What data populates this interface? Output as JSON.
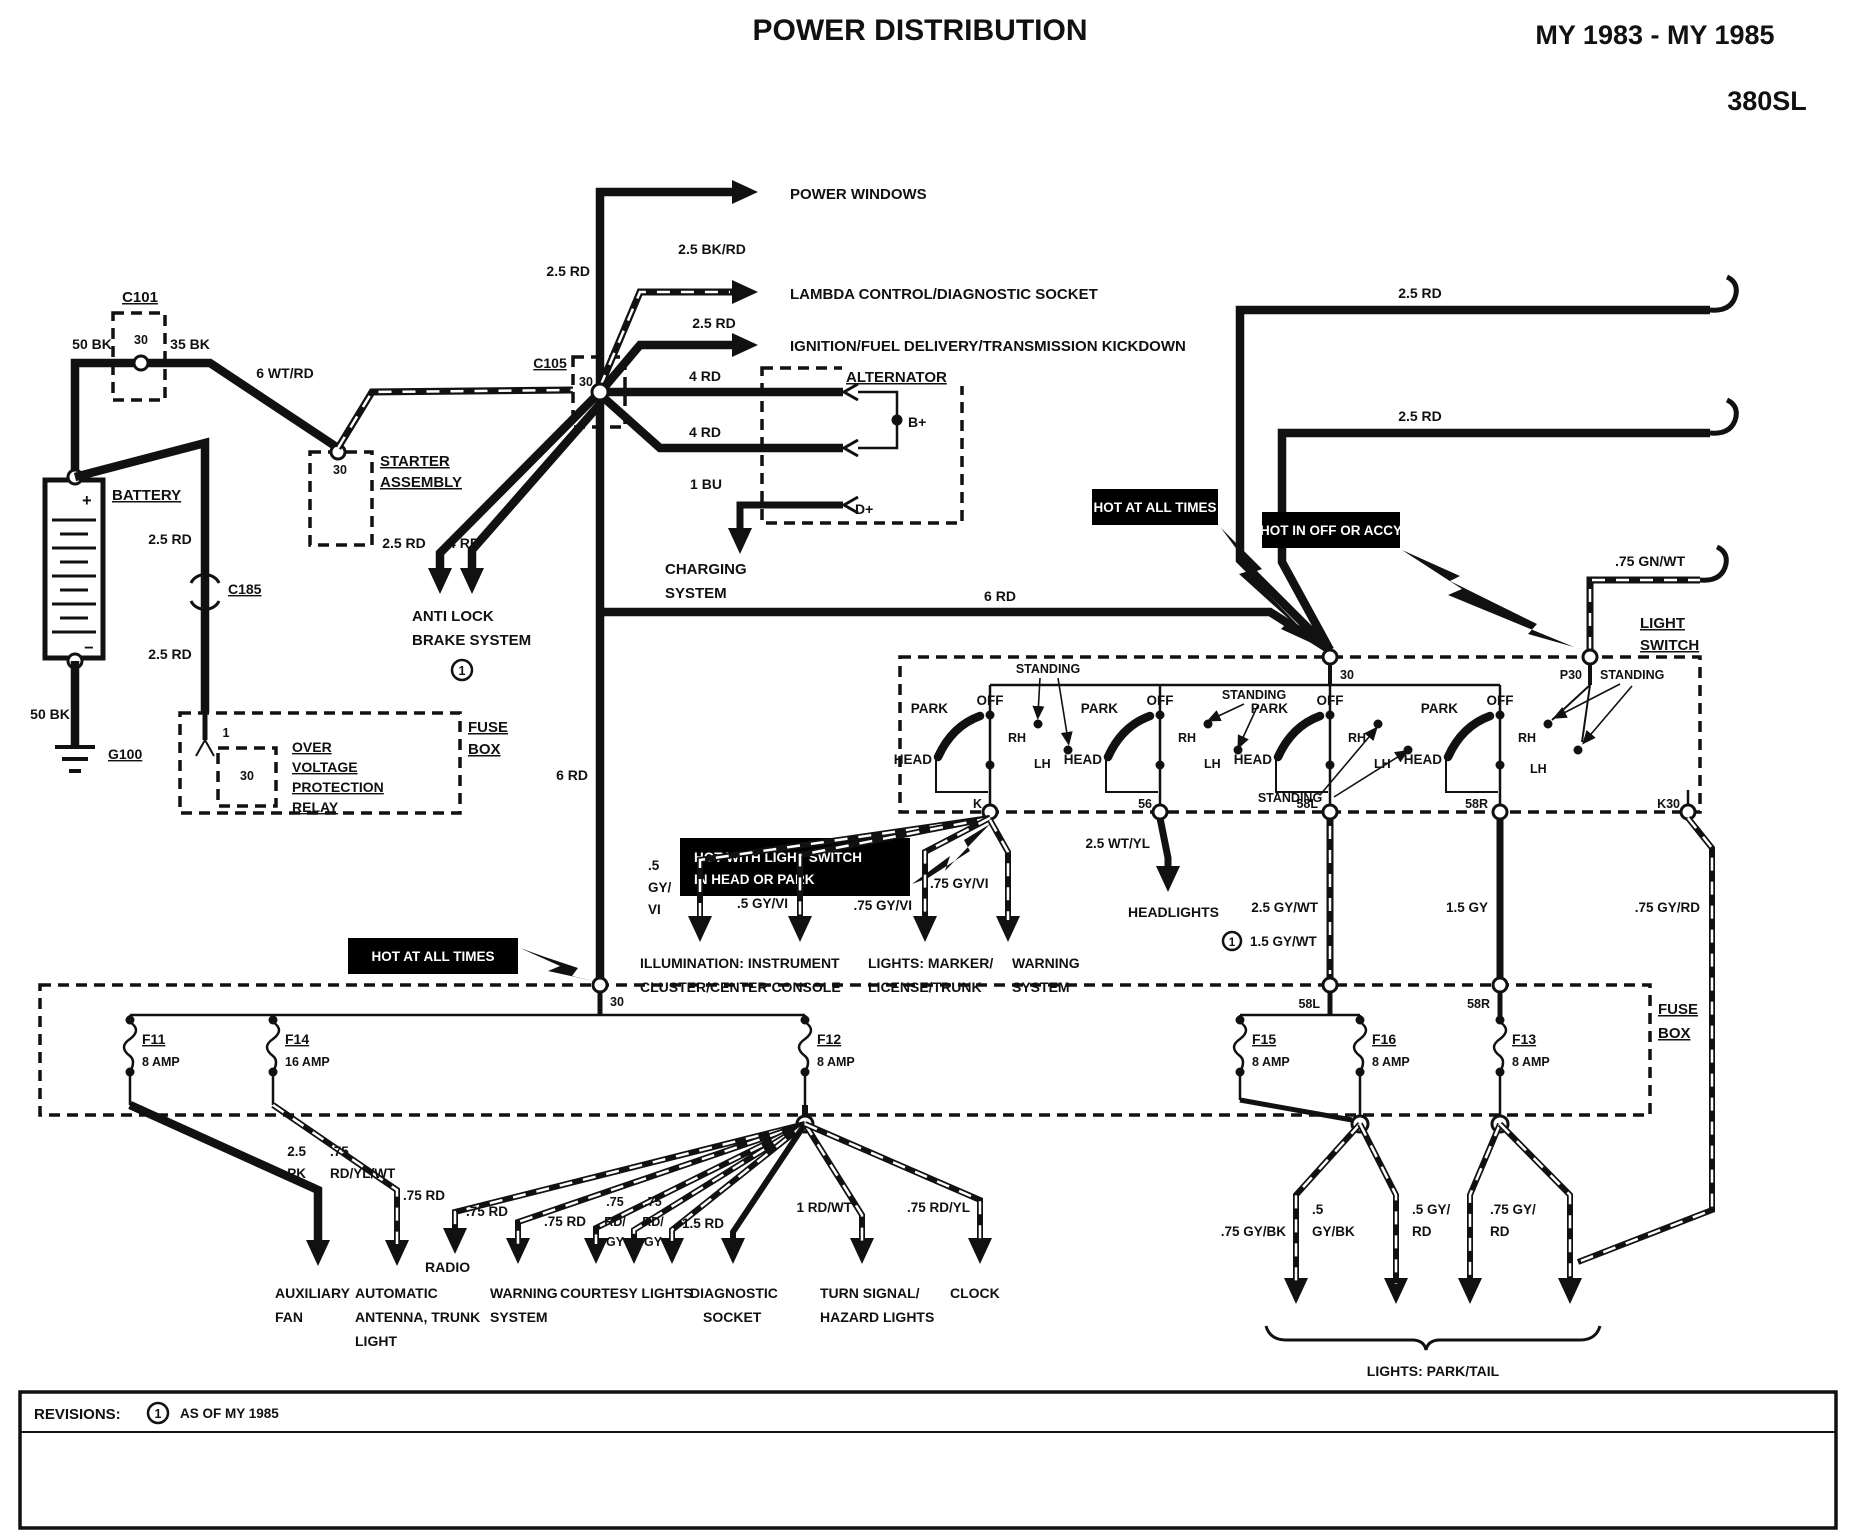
{
  "header": {
    "title": "POWER DISTRIBUTION",
    "model_years": "MY 1983 - MY 1985",
    "model": "380SL"
  },
  "banners": {
    "hot_at_all_times": "HOT AT ALL TIMES",
    "hot_in_off_or_accy": "HOT IN OFF OR ACCY",
    "hot_with_light_switch": [
      "HOT WITH LIGHT SWITCH",
      "IN HEAD OR PARK"
    ]
  },
  "components": {
    "c101": "C101",
    "c105": "C105",
    "c185": "C185",
    "g100": "G100",
    "battery": "BATTERY",
    "battery_plus": "+",
    "battery_minus": "−",
    "starter": [
      "STARTER",
      "ASSEMBLY"
    ],
    "ovp_relay": [
      "OVER",
      "VOLTAGE",
      "PROTECTION",
      "RELAY"
    ],
    "fuse_box": [
      "FUSE",
      "BOX"
    ],
    "alternator": "ALTERNATOR",
    "alt_b_plus": "B+",
    "alt_d_plus": "D+",
    "light_switch": [
      "LIGHT",
      "SWITCH"
    ]
  },
  "terminals": {
    "t30": "30",
    "t1": "1",
    "k": "K",
    "t56": "56",
    "t58l": "58L",
    "t58r": "58R",
    "k30": "K30",
    "p30": "P30"
  },
  "switch": {
    "park": "PARK",
    "off": "OFF",
    "head": "HEAD",
    "rh": "RH",
    "lh": "LH",
    "standing": "STANDING"
  },
  "codes": {
    "bk50": "50 BK",
    "bk35": "35 BK",
    "wtrd6": "6 WT/RD",
    "rd25": "2.5 RD",
    "bkrd25": "2.5 BK/RD",
    "rd4": "4 RD",
    "bu1": "1 BU",
    "rd6": "6 RD",
    "gnwt75": ".75 GN/WT",
    "gyvi5s": [
      ".5",
      "GY/",
      "VI"
    ],
    "gyvi5": ".5 GY/VI",
    "gyvi75": ".75 GY/VI",
    "wtyl25": "2.5 WT/YL",
    "gywt25": "2.5 GY/WT",
    "gywt15": "1.5 GY/WT",
    "gy15": "1.5 GY",
    "gyrd75": ".75 GY/RD",
    "pk25": [
      "2.5",
      "PK"
    ],
    "rdylwt75": [
      ".75",
      "RD/YL/WT"
    ],
    "rd75": ".75 RD",
    "rdgy75": [
      ".75",
      "RD/",
      "GY"
    ],
    "rd15": "1.5 RD",
    "rdwt1": "1 RD/WT",
    "rdyl75": ".75 RD/YL",
    "gybk75": ".75 GY/BK",
    "gybk5": [
      ".5",
      "GY/BK"
    ],
    "gyrd5": [
      ".5 GY/",
      "RD"
    ],
    "gyrd75s": [
      ".75 GY/",
      "RD"
    ]
  },
  "destinations": {
    "power_windows": "POWER WINDOWS",
    "lambda": "LAMBDA CONTROL/DIAGNOSTIC SOCKET",
    "ignition": "IGNITION/FUEL DELIVERY/TRANSMISSION KICKDOWN",
    "charging": [
      "CHARGING",
      "SYSTEM"
    ],
    "abs": [
      "ANTI LOCK",
      "BRAKE SYSTEM"
    ],
    "illumination": [
      "ILLUMINATION: INSTRUMENT",
      "CLUSTER/CENTER CONSOLE"
    ],
    "marker": [
      "LIGHTS: MARKER/",
      "LICENSE/TRUNK"
    ],
    "warning_upper": [
      "WARNING",
      "SYSTEM"
    ],
    "headlights": "HEADLIGHTS",
    "aux_fan": [
      "AUXILIARY",
      "FAN"
    ],
    "antenna": [
      "AUTOMATIC",
      "ANTENNA, TRUNK",
      "LIGHT"
    ],
    "radio": "RADIO",
    "warning_lower": [
      "WARNING",
      "SYSTEM"
    ],
    "courtesy": "COURTESY LIGHTS",
    "diagnostic": [
      "DIAGNOSTIC",
      "SOCKET"
    ],
    "turn_hazard": [
      "TURN SIGNAL/",
      "HAZARD LIGHTS"
    ],
    "clock": "CLOCK",
    "park_tail": "LIGHTS: PARK/TAIL"
  },
  "fuses": [
    {
      "name": "F11",
      "rating": "8 AMP"
    },
    {
      "name": "F14",
      "rating": "16 AMP"
    },
    {
      "name": "F12",
      "rating": "8 AMP"
    },
    {
      "name": "F15",
      "rating": "8 AMP"
    },
    {
      "name": "F16",
      "rating": "8 AMP"
    },
    {
      "name": "F13",
      "rating": "8 AMP"
    }
  ],
  "marks": {
    "rev1": "1"
  },
  "revisions": {
    "label": "REVISIONS:",
    "note": "AS OF MY 1985"
  },
  "colors": {
    "ink": "#111111",
    "paper": "#ffffff",
    "banner_bg": "#000000",
    "banner_fg": "#ffffff"
  }
}
